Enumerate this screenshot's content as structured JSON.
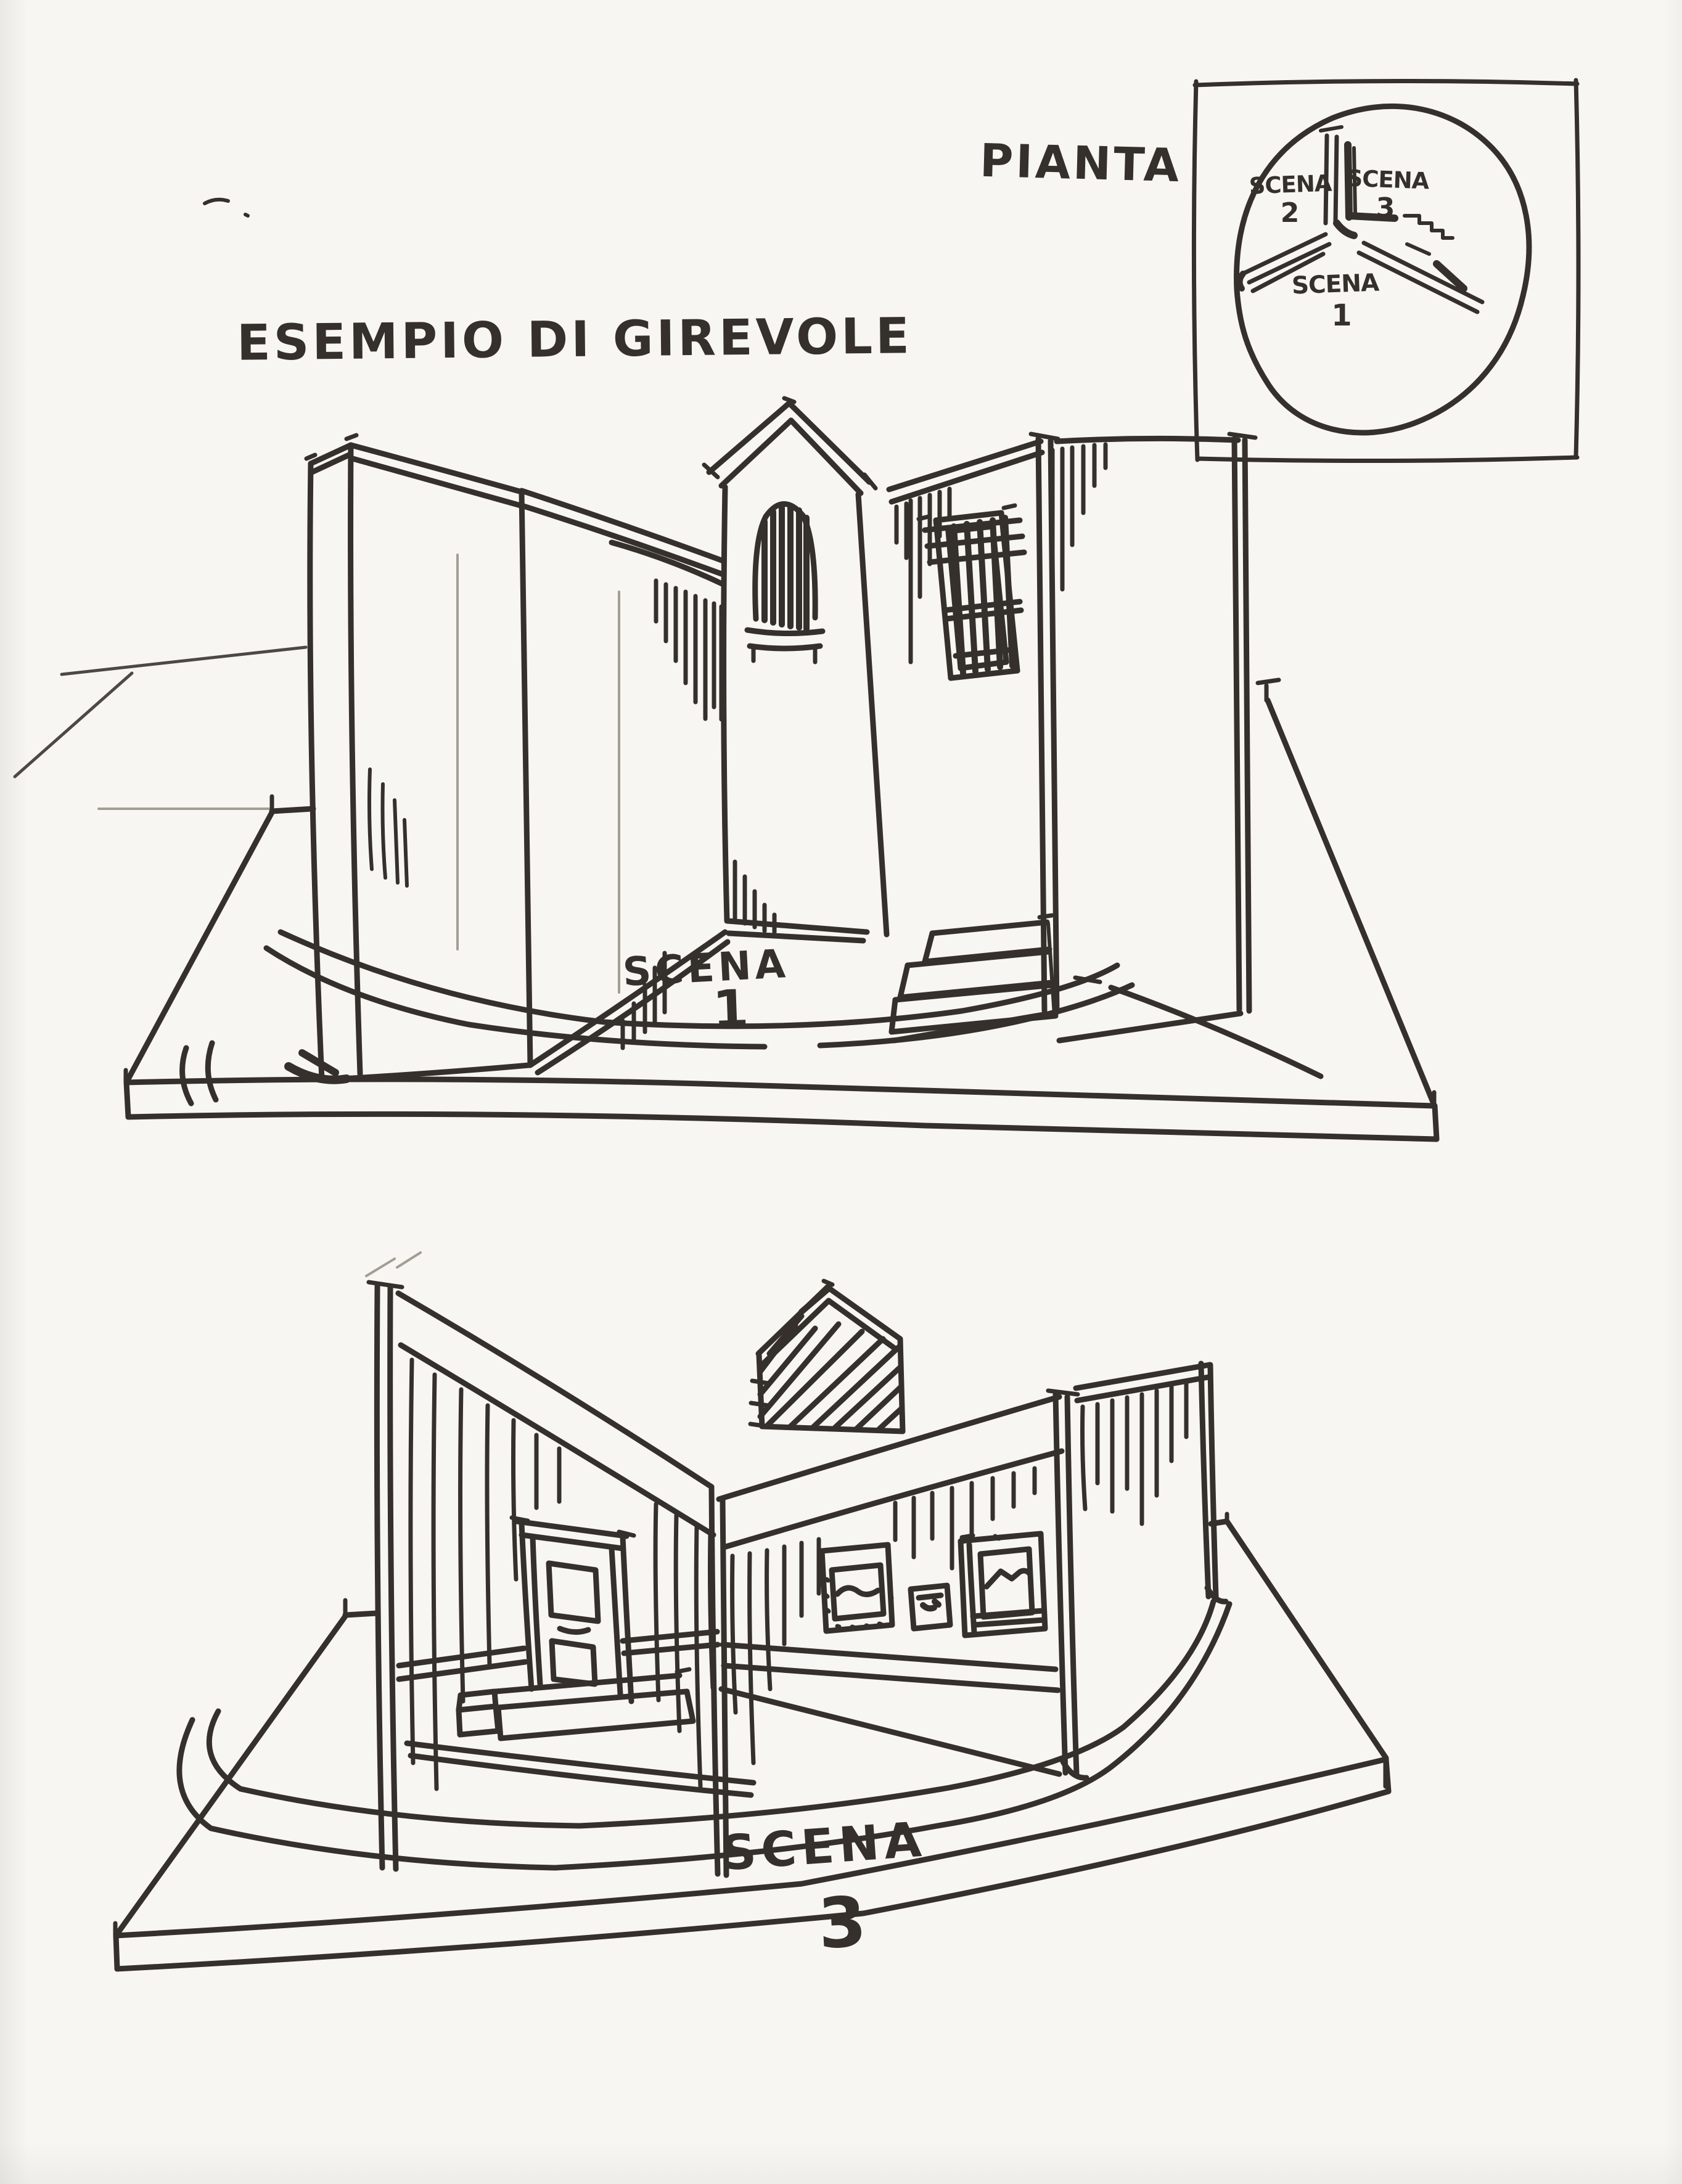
{
  "colors": {
    "paper": "#f7f6f2",
    "ink": "#35302b",
    "pencil": "#a39d94"
  },
  "title": "ESEMPIO DI GIREVOLE",
  "plan": {
    "label": "PIANTA",
    "sector_upper_left": {
      "word": "SCENA",
      "number": "2"
    },
    "sector_upper_right": {
      "word": "SCENA",
      "number": "3"
    },
    "sector_bottom": {
      "word": "SCENA",
      "number": "1"
    }
  },
  "scene1": {
    "word": "SCENA",
    "number": "1"
  },
  "scene3": {
    "word": "SCENA",
    "number": "3"
  }
}
